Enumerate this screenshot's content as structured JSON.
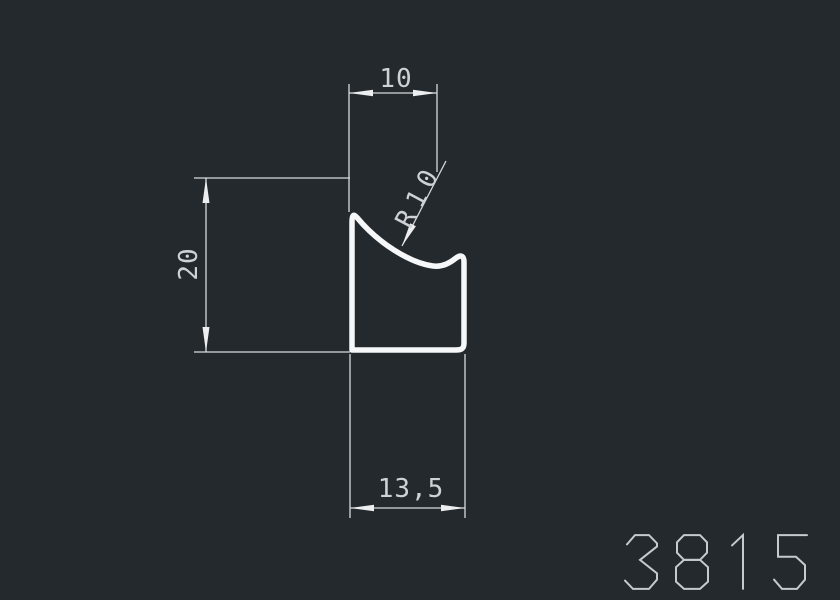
{
  "drawing": {
    "title": "profile-cross-section-drawing",
    "product_number": "3815",
    "dimensions": {
      "top_width": "10",
      "height": "20",
      "bottom_width": "13,5",
      "radius": "R10"
    },
    "colors": {
      "background": "#24292e",
      "profile_stroke": "#f5f7f8",
      "dimension_lines": "#d7dadc",
      "dimension_text": "#ced2d5",
      "product_number_text": "#c6cacd"
    }
  }
}
